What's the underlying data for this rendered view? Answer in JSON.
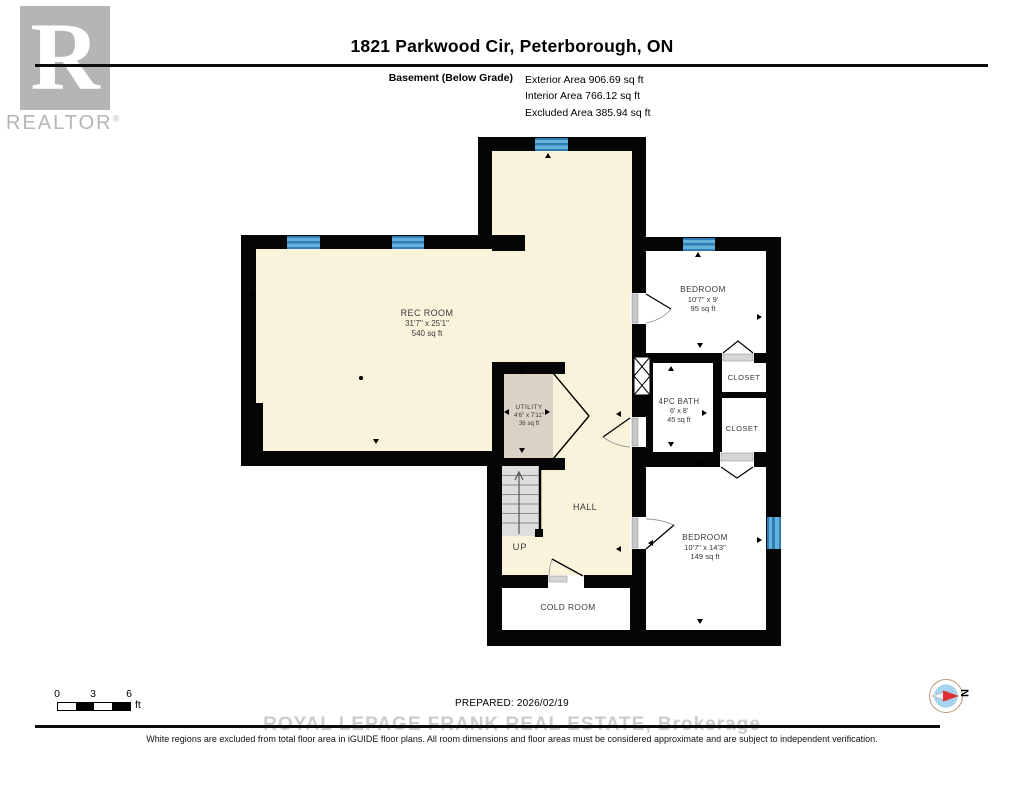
{
  "header": {
    "logo": {
      "letter": "R",
      "wordmark": "REALTOR",
      "registered": "®"
    },
    "title": "1821 Parkwood Cir, Peterborough, ON",
    "floor_label": "Basement (Below Grade)",
    "area_lines": [
      "Exterior Area 906.69 sq ft",
      "Interior Area 766.12 sq ft",
      "Excluded Area 385.94 sq ft"
    ]
  },
  "plan": {
    "rooms": [
      {
        "name": "REC ROOM",
        "dims": "31'7\" x 25'1\"",
        "area": "540 sq ft"
      },
      {
        "name": "UTILITY",
        "dims": "4'6\" x 7'11\"",
        "area": "36 sq ft"
      },
      {
        "name": "HALL"
      },
      {
        "name": "BEDROOM",
        "dims": "10'7\" x 9'",
        "area": "95 sq ft"
      },
      {
        "name": "CLOSET"
      },
      {
        "name": "4PC BATH",
        "dims": "6' x 8'",
        "area": "45 sq ft"
      },
      {
        "name": "CLOSET"
      },
      {
        "name": "BEDROOM",
        "dims": "10'7\" x 14'3\"",
        "area": "149 sq ft"
      },
      {
        "name": "COLD ROOM"
      }
    ],
    "stairs_label": "UP"
  },
  "footer": {
    "scale": {
      "ticks": [
        "0",
        "3",
        "6"
      ],
      "unit": "ft"
    },
    "prepared": "PREPARED: 2026/02/19",
    "watermark": "ROYAL LEPAGE FRANK REAL ESTATE, Brokerage",
    "disclaimer": "White regions are excluded from total floor area in iGUIDE floor plans. All room dimensions and floor areas must be considered approximate and are subject to independent verification.",
    "compass_label": "N"
  },
  "colors": {
    "wall": "#050505",
    "floor_included": "#FAF3DC",
    "floor_excluded": "#FFFFFF",
    "utility_fill": "#D9D2C5",
    "window_blue": "#64B2DC",
    "window_blue_dark": "#2F7CB5",
    "compass_needle_red": "#E03030",
    "watermark_gray": "#CBCBCB",
    "logo_gray": "#B5B5B5"
  }
}
